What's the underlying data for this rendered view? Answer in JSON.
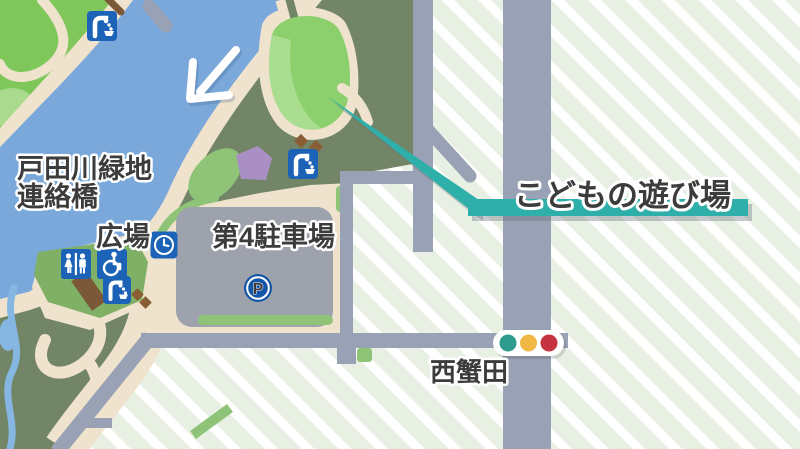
{
  "labels": {
    "river_name_line1": "戸田川緑地",
    "river_name_line2": "連絡橋",
    "plaza": "広場",
    "parking": "第4駐車場",
    "playground": "こどもの遊び場",
    "intersection": "西蟹田"
  },
  "parking_icon": {
    "letter": "P"
  },
  "icons": [
    "water-fountain-icon",
    "water-fountain-icon",
    "water-fountain-icon",
    "toilet-icon",
    "wheelchair-icon",
    "clock-icon",
    "parking-p-icon",
    "traffic-signal-icon",
    "direction-arrow-icon"
  ],
  "colors": {
    "stripe_base": "#E8F0E4",
    "stripe_white": "#FFFFFF",
    "park_green": "#728566",
    "bright_corner_green": "#7FC75A",
    "lawn_light_green": "#A9DA8D",
    "playground_green": "#8CD06E",
    "playground_light_green": "#A9DE90",
    "plaza_green": "#7FB066",
    "accent_green": "#8FC478",
    "river_blue": "#7AA8DB",
    "stream_blue": "#86B7E3",
    "path_beige": "#EFE3CE",
    "road_gray": "#99A1B4",
    "parking_gray": "#9EA2AC",
    "icon_blue": "#1C63B7",
    "p_circle_blue": "#1356A8",
    "building_purple": "#A98FC4",
    "bench_brown": "#7B5837",
    "diamond_brown": "#8A5E35",
    "callout_teal": "#2FAFA9",
    "signal_green": "#2F9C8D",
    "signal_yellow": "#F0B844",
    "signal_red": "#C63441",
    "label_text": "#3C3C3C",
    "label_outline": "#FFFFFF"
  }
}
